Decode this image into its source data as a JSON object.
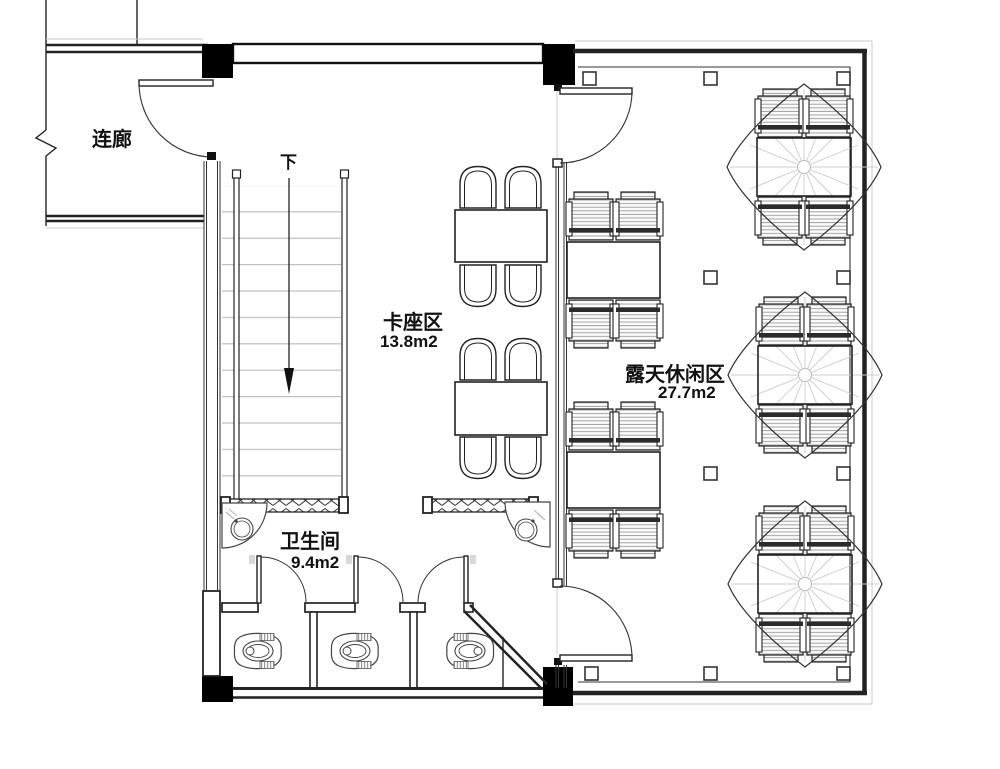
{
  "drawing": {
    "title": "floor-plan",
    "areas": {
      "corridor": {
        "label": "连廊"
      },
      "stairs": {
        "direction_label": "下"
      },
      "booth": {
        "name": "卡座区",
        "size": "13.8m2"
      },
      "outdoor": {
        "name": "露天休闲区",
        "size": "27.7m2"
      },
      "restroom": {
        "name": "卫生间",
        "size": "9.4m2"
      }
    },
    "colors": {
      "line": "#1a1a1a",
      "light_line": "#c8c8c8",
      "fill": "#ffffff"
    }
  }
}
